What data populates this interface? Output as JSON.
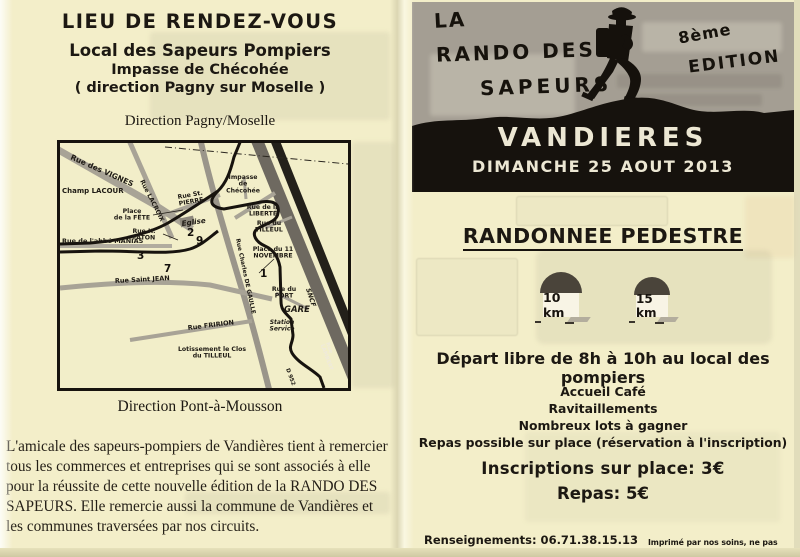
{
  "colors": {
    "paper": "#f3eec9",
    "header_gray": "#a49e93",
    "ink_black": "#1c1812",
    "cream_text": "#ece7d3"
  },
  "left_page": {
    "title": "LIEU DE RENDEZ-VOUS",
    "venue": {
      "name": "Local des Sapeurs Pompiers",
      "street": "Impasse de Chécohée",
      "direction": "( direction Pagny sur Moselle )"
    },
    "map_caption_top": "Direction Pagny/Moselle",
    "map_caption_bottom": "Direction Pont-à-Mousson",
    "acknowledgement": "L'amicale des sapeurs-pompiers de Vandières tient à remercier tous les commerces et entreprises qui se sont associés à elle pour la réussite de cette nouvelle édition de la RANDO DES SAPEURS. Elle remercie aussi la commune de Vandières et les communes traversées par nos circuits.",
    "map": {
      "labels": [
        {
          "t": "Rue des VIGNES",
          "x": 10,
          "y": 16,
          "r": 24,
          "s": 7.5
        },
        {
          "t": "Champ LACOUR",
          "x": 2,
          "y": 50,
          "s": 7
        },
        {
          "t": "Rue LACROIX",
          "x": 80,
          "y": 38,
          "r": 63,
          "s": 6.2
        },
        {
          "t": "Rue St.\nPIERRE",
          "x": 118,
          "y": 56,
          "r": -10,
          "s": 6.2
        },
        {
          "t": "Impasse\nde\nChécohée",
          "x": 183,
          "y": 36,
          "s": 6.2,
          "a": "middle"
        },
        {
          "t": "Place\nde la FÊTE",
          "x": 72,
          "y": 70,
          "s": 6.2,
          "a": "middle"
        },
        {
          "t": "Eglise",
          "x": 122,
          "y": 83,
          "r": -8,
          "s": 7.2,
          "i": 1
        },
        {
          "t": "Rue de la\nLIBERTÉ",
          "x": 203,
          "y": 66,
          "s": 6.2,
          "a": "middle"
        },
        {
          "t": "Rue du\nTILLEUL",
          "x": 209,
          "y": 82,
          "s": 6.2,
          "a": "middle"
        },
        {
          "t": "Rue H.\nFATON",
          "x": 84,
          "y": 90,
          "s": 6.2,
          "a": "middle"
        },
        {
          "t": "Rue de l'abbé MANIAS",
          "x": 2,
          "y": 100,
          "s": 6.5
        },
        {
          "t": "Place du 11\nNOVEMBRE",
          "x": 213,
          "y": 108,
          "s": 6.2,
          "a": "middle"
        },
        {
          "t": "Rue Saint JEAN",
          "x": 55,
          "y": 140,
          "r": -3,
          "s": 6.5
        },
        {
          "t": "Rue Charles DE GAULLE",
          "x": 176,
          "y": 96,
          "r": 78,
          "s": 5.8
        },
        {
          "t": "Rue du\nPORT",
          "x": 224,
          "y": 148,
          "s": 6.2,
          "a": "middle"
        },
        {
          "t": "GARE",
          "x": 224,
          "y": 169,
          "s": 8.5,
          "i": 1
        },
        {
          "t": "Rue FRIRION",
          "x": 128,
          "y": 187,
          "r": -7,
          "s": 6.5
        },
        {
          "t": "Station\nService",
          "x": 222,
          "y": 181,
          "s": 6,
          "a": "middle",
          "i": 1
        },
        {
          "t": "Lotissement le Clos\ndu TILLEUL",
          "x": 152,
          "y": 208,
          "s": 6.2,
          "a": "middle"
        },
        {
          "t": "SNCF",
          "x": 246,
          "y": 146,
          "r": 72,
          "s": 6.5,
          "i": 1
        },
        {
          "t": "Rue\nLAMBERT",
          "x": 266,
          "y": 200,
          "r": 70,
          "s": 5.2,
          "w": 1
        },
        {
          "t": "D 952",
          "x": 226,
          "y": 226,
          "r": 70,
          "s": 5.5
        }
      ],
      "route_numbers": [
        {
          "t": "2",
          "x": 127,
          "y": 93
        },
        {
          "t": "9",
          "x": 136,
          "y": 101
        },
        {
          "t": "3",
          "x": 77,
          "y": 116
        },
        {
          "t": "7",
          "x": 104,
          "y": 129
        },
        {
          "t": "1",
          "x": 200,
          "y": 134
        }
      ]
    }
  },
  "right_page": {
    "header": {
      "title_line1": "LA",
      "title_line2": "RANDO DES",
      "title_line3": "SAPEURS",
      "edition_line1": "8ème",
      "edition_line2": "EDITION",
      "town": "VANDIERES",
      "date": "DIMANCHE 25 AOUT 2013"
    },
    "section_title": "RANDONNEE PEDESTRE",
    "distance_markers": [
      "10 km",
      "15 km"
    ],
    "departure": "Départ libre de 8h à 10h au local des pompiers",
    "amenities": [
      "Accueil Café",
      "Ravitaillements",
      "Nombreux lots à gagner",
      "Repas possible sur place (réservation à l'inscription)"
    ],
    "prices": {
      "registration": "Inscriptions sur place: 3€",
      "meal": "Repas: 5€"
    },
    "footer": {
      "contact": "Renseignements: 06.71.38.15.13",
      "legal": "Imprimé par nos soins, ne pas jeter sur la voie publique"
    }
  }
}
